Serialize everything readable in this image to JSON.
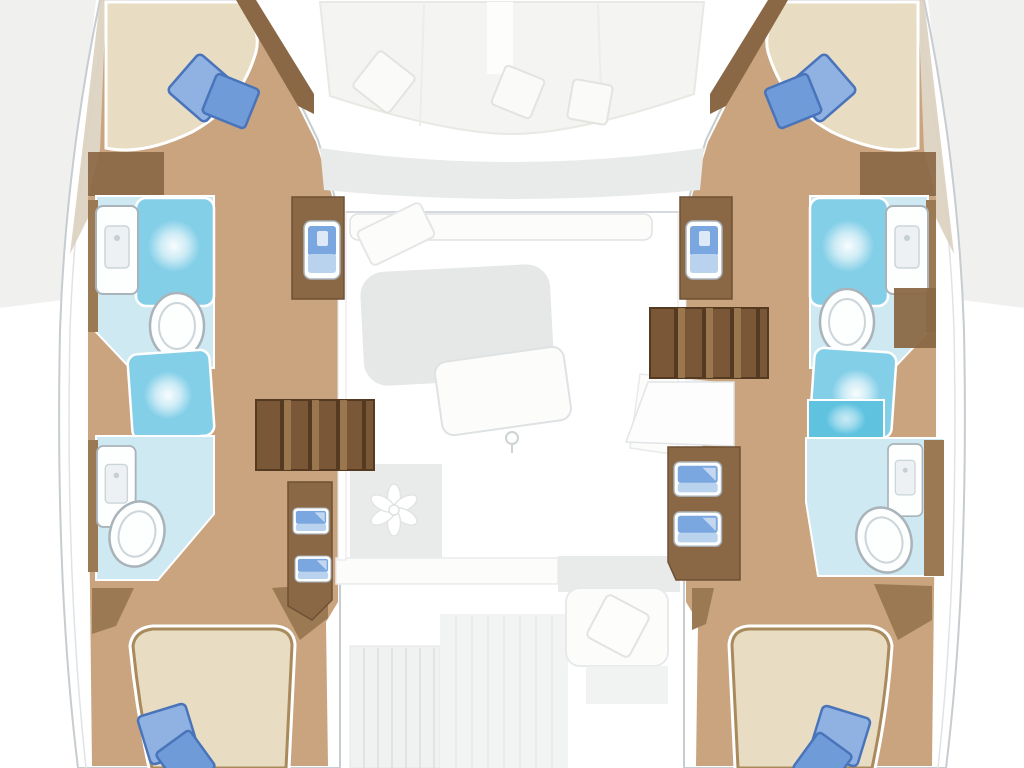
{
  "diagram": {
    "type": "floorplan",
    "subject": "Catamaran yacht interior deck plan, top-down view, four cabins with bathrooms, central salon and cockpits",
    "hulls": [
      {
        "side": "port",
        "rooms": [
          {
            "name": "forward cabin",
            "furniture": [
              "double berth",
              "blue pillow pair"
            ]
          },
          {
            "name": "forward bathroom",
            "fixtures": [
              "sink console",
              "shower pad",
              "toilet"
            ]
          },
          {
            "name": "mid shower",
            "fixtures": [
              "shower pad"
            ]
          },
          {
            "name": "aft bathroom",
            "fixtures": [
              "sink console",
              "toilet"
            ]
          },
          {
            "name": "aft cabin",
            "furniture": [
              "double berth",
              "blue pillow pair"
            ]
          }
        ],
        "features": [
          "companionway stairs",
          "vanity basin cabinet",
          "drawer cabinet"
        ]
      },
      {
        "side": "starboard",
        "rooms": [
          {
            "name": "forward cabin",
            "furniture": [
              "double berth",
              "blue pillow pair"
            ]
          },
          {
            "name": "forward bathroom",
            "fixtures": [
              "sink console",
              "shower pad",
              "toilet"
            ]
          },
          {
            "name": "mid shower",
            "fixtures": [
              "shower pad"
            ]
          },
          {
            "name": "aft bathroom",
            "fixtures": [
              "shower pad",
              "sink console",
              "toilet"
            ]
          },
          {
            "name": "aft cabin",
            "furniture": [
              "double berth",
              "blue pillow pair"
            ]
          }
        ],
        "features": [
          "companionway stairs",
          "landing platform",
          "vanity basin cabinet",
          "drawer cabinet"
        ]
      }
    ],
    "deck": {
      "areas": [
        "bow lounge with cushions and three pillows",
        "salon with settee band, sofa and tilted table",
        "galley area with fan vent",
        "aft cockpit with slatted bench, center panel and pillow seat"
      ]
    },
    "counts": {
      "cabins": 4,
      "bathrooms": 4,
      "toilets": 4,
      "berths": 4,
      "shower_pads": 5,
      "sink_consoles": 4,
      "vanity_basins": 2,
      "storage_drawers": 4,
      "stair_flights": 2
    },
    "colors": {
      "bg": "#ffffff",
      "outside-shade": "#ededec",
      "hull-line": "#c6ccd0",
      "hull-line-soft": "#dfe3e5",
      "bow-deck": "#dcd0bf",
      "wood": "#c9a47e",
      "wood-dark": "#8a6845",
      "wood-wall": "#9b7a53",
      "stairs": "#7a5737",
      "stairs-line": "#a07c52",
      "stairs-dark": "#543a20",
      "mattress": "#e8dcc3",
      "mattress-edge": "#a98a5c",
      "pillow": "#6f9bd8",
      "pillow-dark": "#4a74ba",
      "pillow-light": "#8fb2e2",
      "sink-blue": "#7ba7e0",
      "sink-blue-light": "#b9d3ef",
      "bath-floor": "#cfe9f2",
      "shower": "#84cfe8",
      "shower-deep": "#5fc3e0",
      "fixture": "#fdfefe",
      "fixture-line": "#a9b3ba",
      "fixture-inner": "#ccd5d9",
      "deck-soft": "#f4f4f2",
      "deck-mid": "#e9eaea",
      "deck-line": "#dfe2e3",
      "deck-white": "#fcfcfb"
    }
  }
}
